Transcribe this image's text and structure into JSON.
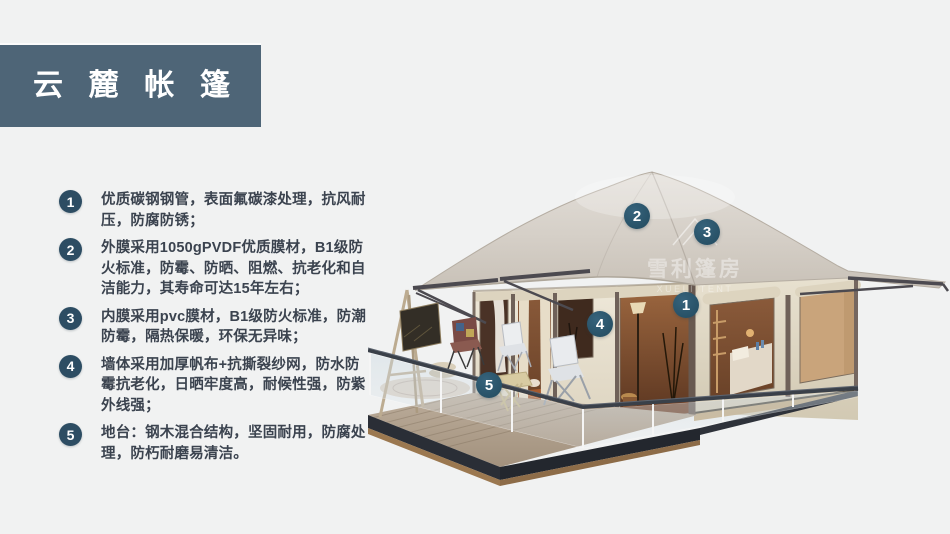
{
  "header": {
    "title": "云麓帐篷",
    "title_chars": [
      "云",
      "麓",
      "帐",
      "篷"
    ]
  },
  "features": [
    {
      "num": "1",
      "text": "优质碳钢钢管，表面氟碳漆处理，抗风耐压，防腐防锈；"
    },
    {
      "num": "2",
      "text": "外膜采用1050gPVDF优质膜材，B1级防火标准，防霉、防晒、阻燃、抗老化和自洁能力，其寿命可达15年左右；"
    },
    {
      "num": "3",
      "text": "内膜采用pvc膜材，B1级防火标准，防潮防霉，隔热保暖，环保无异味；"
    },
    {
      "num": "4",
      "text": "墙体采用加厚帆布+抗撕裂纱网，防水防霉抗老化，日晒牢度高，耐候性强，防紫外线强；"
    },
    {
      "num": "5",
      "text": "地台：钢木混合结构，坚固耐用，防腐处理，防朽耐磨易清洁。"
    }
  ],
  "illustration": {
    "watermark": {
      "brand": "雪利篷房",
      "brand_en": "XUELI TENT"
    },
    "callouts": [
      {
        "label": "1"
      },
      {
        "label": "2"
      },
      {
        "label": "3"
      },
      {
        "label": "4"
      },
      {
        "label": "5"
      }
    ]
  },
  "colors": {
    "background": "#f1f2f2",
    "banner": "#4e6577",
    "bullet": "#2d4d63",
    "badge": "#2a546a",
    "body_text": "#3b434f",
    "roof": "#d6d0c8",
    "wall": "#e9e2d2"
  }
}
